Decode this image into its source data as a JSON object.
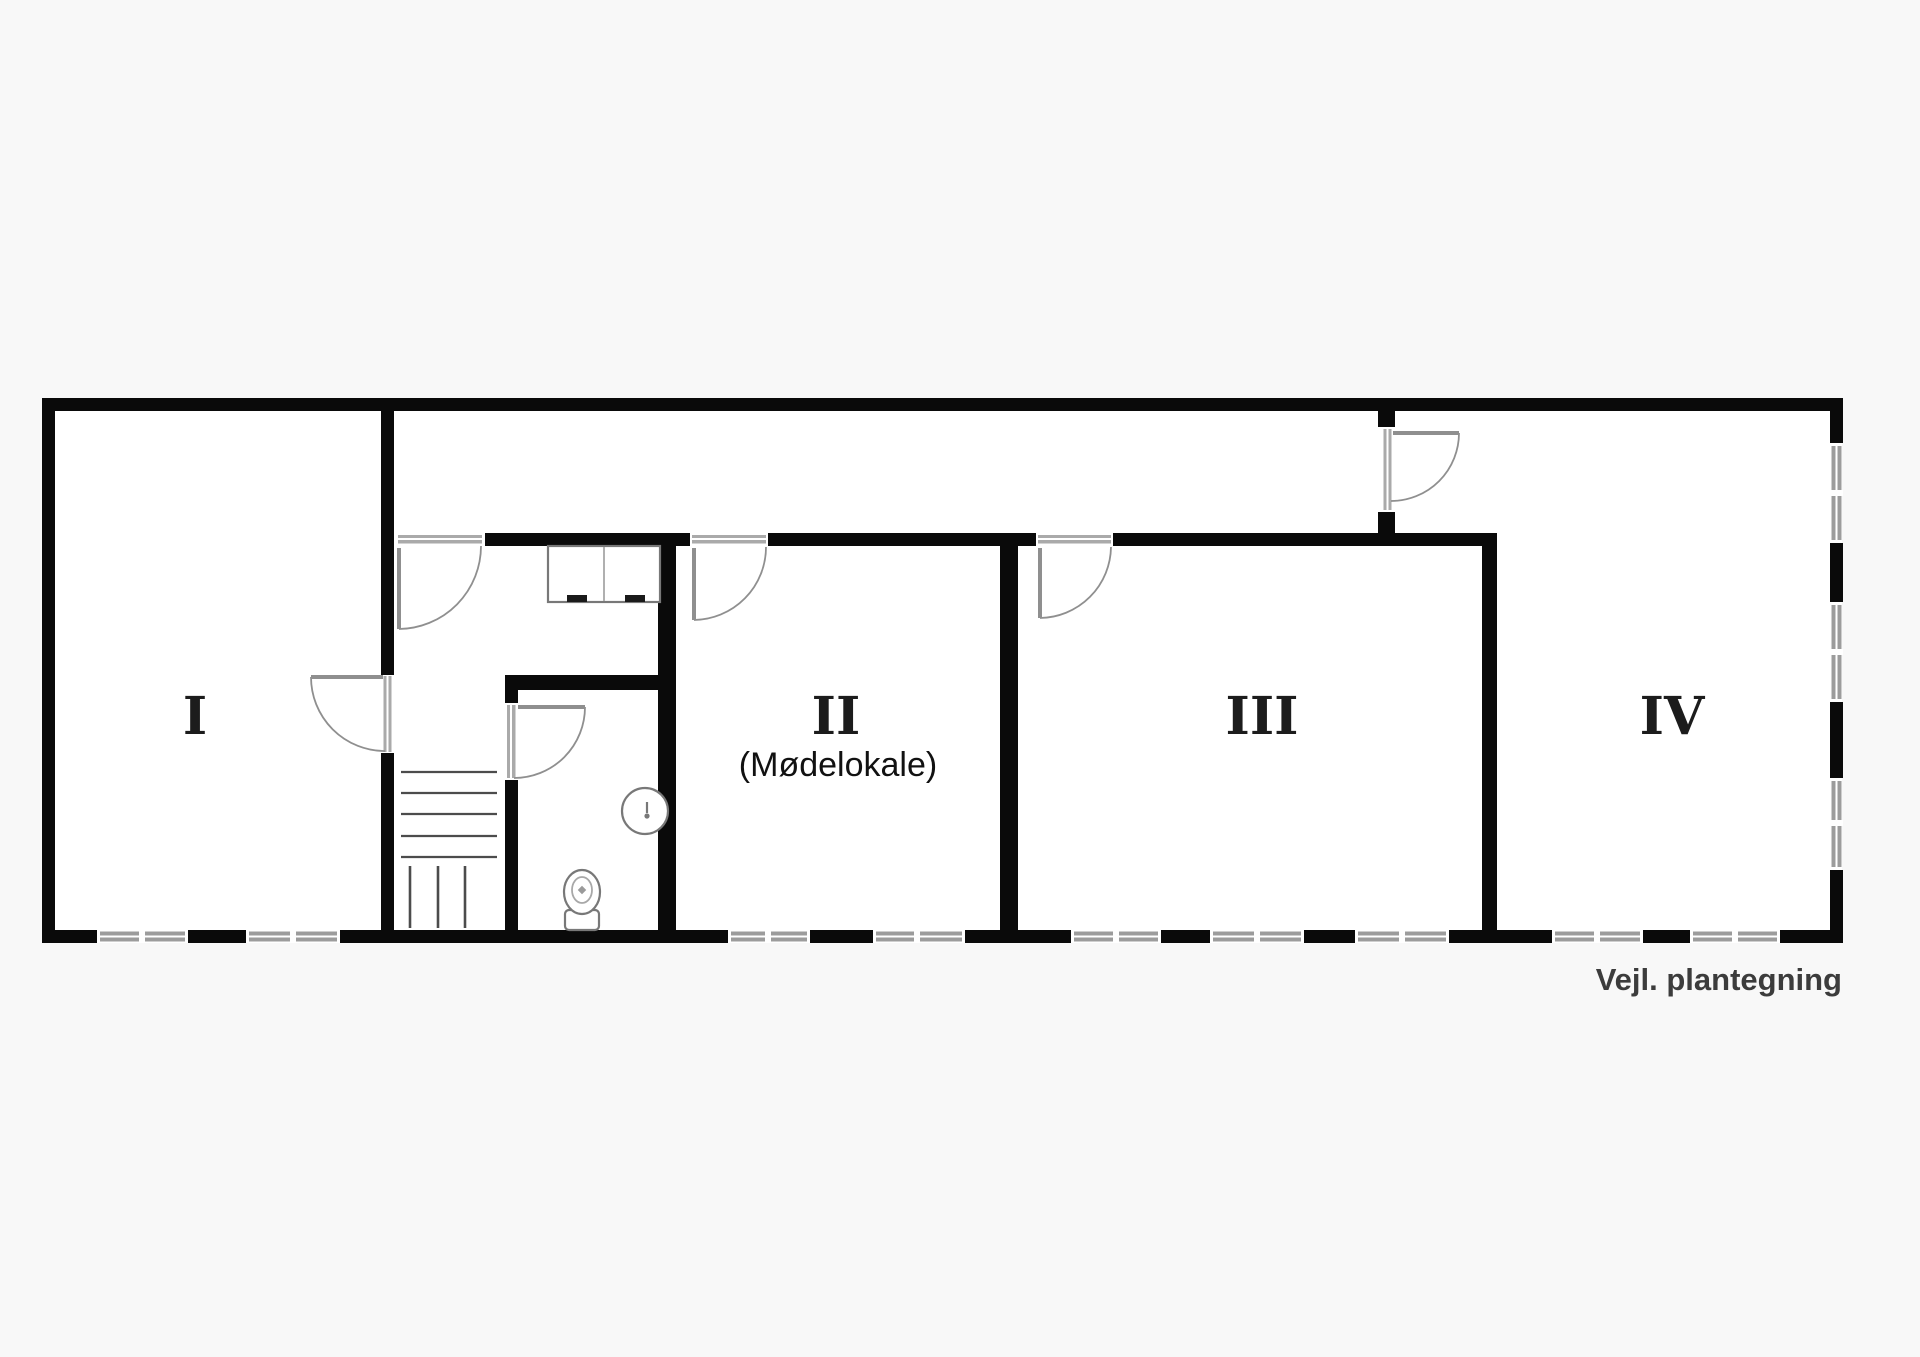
{
  "floor_plan": {
    "caption": "Vejl. plantegning",
    "rooms": [
      {
        "label": "I"
      },
      {
        "label": "II",
        "sublabel": "(Mødelokale)"
      },
      {
        "label": "III"
      },
      {
        "label": "IV"
      }
    ],
    "fixtures": {
      "staircase": "staircase",
      "toilet": "toilet",
      "washbasin": "washbasin",
      "cabinet": "cabinet"
    },
    "colors": {
      "wall": "#0a0a0a",
      "window": "#9c9c9c",
      "door": "#8f8f8f",
      "floor": "#ffffff",
      "background": "#f8f8f8",
      "label": "#1c1c1c",
      "caption": "#3c3c3c"
    }
  }
}
